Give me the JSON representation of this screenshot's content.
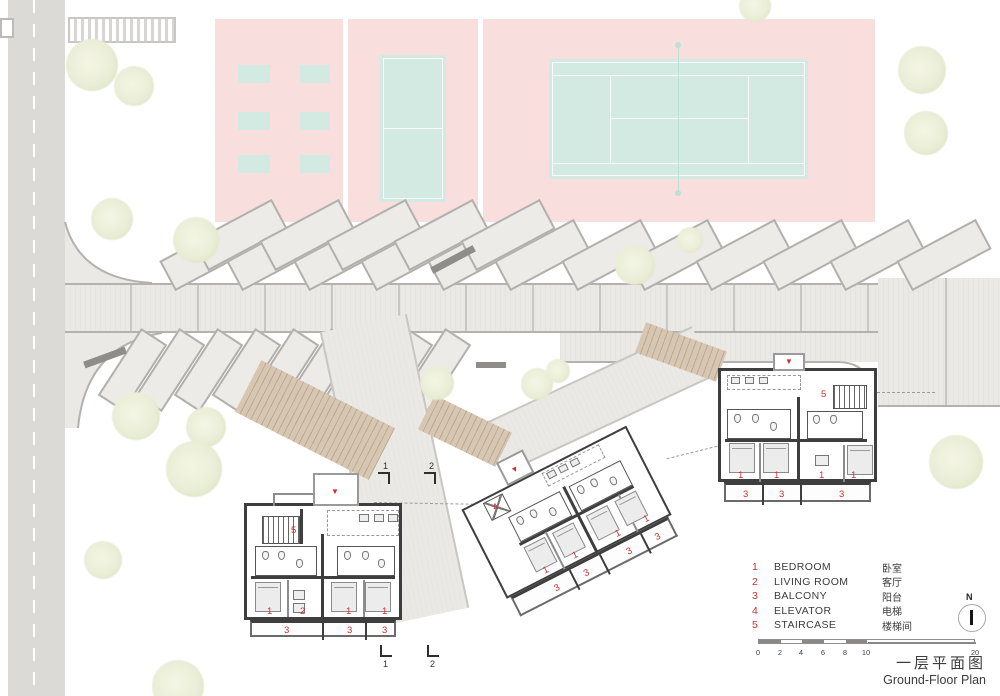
{
  "plan": {
    "title_cn": "一层平面图",
    "title_en": "Ground-Floor Plan",
    "north_label": "N",
    "entry_arrow": "▼"
  },
  "legend": {
    "items": [
      {
        "num": "1",
        "en": "BEDROOM",
        "cn": "卧室"
      },
      {
        "num": "2",
        "en": "LIVING ROOM",
        "cn": "客厅"
      },
      {
        "num": "3",
        "en": "BALCONY",
        "cn": "阳台"
      },
      {
        "num": "4",
        "en": "ELEVATOR",
        "cn": "电梯"
      },
      {
        "num": "5",
        "en": "STAIRCASE",
        "cn": "楼梯间"
      }
    ]
  },
  "scale_bar": {
    "labels": [
      "0",
      "2",
      "4",
      "6",
      "8",
      "10",
      "20"
    ]
  },
  "sections": {
    "marker1": "1",
    "marker2": "2"
  },
  "buildings": {
    "left": {
      "labels": [
        "5",
        "1",
        "2",
        "1",
        "1",
        "3",
        "3",
        "3"
      ]
    },
    "middle": {
      "labels": [
        "4",
        "1",
        "1",
        "1",
        "1",
        "3",
        "3",
        "3",
        "3"
      ]
    },
    "right": {
      "labels": [
        "5",
        "1",
        "1",
        "1",
        "1",
        "3",
        "3",
        "3"
      ]
    }
  },
  "colors": {
    "sports_ground": "#f8dedd",
    "courts": "#d3eae2",
    "walkway": "#ebe9e5",
    "walls": "#3e3e3e",
    "labels_accent": "#cf2f2f"
  }
}
